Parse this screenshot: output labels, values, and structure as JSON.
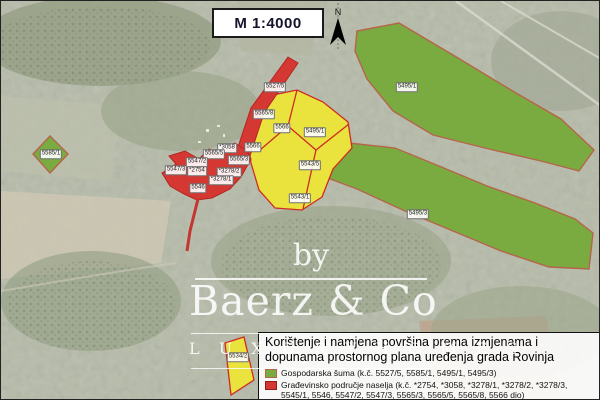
{
  "map": {
    "scale_label": "M 1:4000",
    "north_label": "N"
  },
  "parcels": [
    {
      "label": "5527/5",
      "x": 274,
      "y": 86
    },
    {
      "label": "5565/8",
      "x": 263,
      "y": 113
    },
    {
      "label": "5566",
      "x": 281,
      "y": 127
    },
    {
      "label": "5495/1",
      "x": 314,
      "y": 131
    },
    {
      "label": "5566",
      "x": 252,
      "y": 146
    },
    {
      "label": "*3058",
      "x": 226,
      "y": 147
    },
    {
      "label": "5565/5",
      "x": 213,
      "y": 153
    },
    {
      "label": "5565/3",
      "x": 238,
      "y": 159
    },
    {
      "label": "5547/2",
      "x": 196,
      "y": 161
    },
    {
      "label": "5547/3",
      "x": 175,
      "y": 169
    },
    {
      "label": "*2754",
      "x": 196,
      "y": 170
    },
    {
      "label": "*3278/2",
      "x": 228,
      "y": 171
    },
    {
      "label": "*3278/1",
      "x": 220,
      "y": 179
    },
    {
      "label": "5546",
      "x": 197,
      "y": 187
    },
    {
      "label": "5543/5",
      "x": 309,
      "y": 164
    },
    {
      "label": "5543/1",
      "x": 299,
      "y": 197
    },
    {
      "label": "5495/1",
      "x": 406,
      "y": 86
    },
    {
      "label": "5495/3",
      "x": 417,
      "y": 213
    },
    {
      "label": "5585/1",
      "x": 50,
      "y": 153
    },
    {
      "label": "5534/2",
      "x": 237,
      "y": 356
    }
  ],
  "watermark": {
    "by": "by",
    "brand": "Baerz & Co",
    "tagline": "L U X U R Y   H O M E S"
  },
  "legend": {
    "title_line1": "Korištenje i namjena površina prema izmjenama i",
    "title_line2": "dopunama prostornog plana uređenja grada Rovinja",
    "items": [
      {
        "zone": "forest",
        "swatch": "green",
        "label": "Gospodarska šuma (k.č. 5527/5, 5585/1, 5495/1, 5495/3)"
      },
      {
        "zone": "settlement",
        "swatch": "red",
        "label": "Građevinsko područje naselja (k.č. *2754, *3058, *3278/1, *3278/2, *3278/3, 5545/1, 5546, 5547/2, 5547/3, 5565/3, 5565/5, 5565/8, 5566 dio)"
      },
      {
        "zone": "farmland",
        "swatch": "yellow",
        "label": "Osobito vrijedno obradivo tlo (k.č. 5495/1, 5534/2, 5543/1, 5543/5, 5566 dio)"
      }
    ]
  },
  "colors": {
    "forest_fill": "#7aab40",
    "farmland_fill": "#eae23d",
    "settlement_fill": "#d53832",
    "zone_border_red": "#cf2b24",
    "forest_border": "#b5654a"
  }
}
